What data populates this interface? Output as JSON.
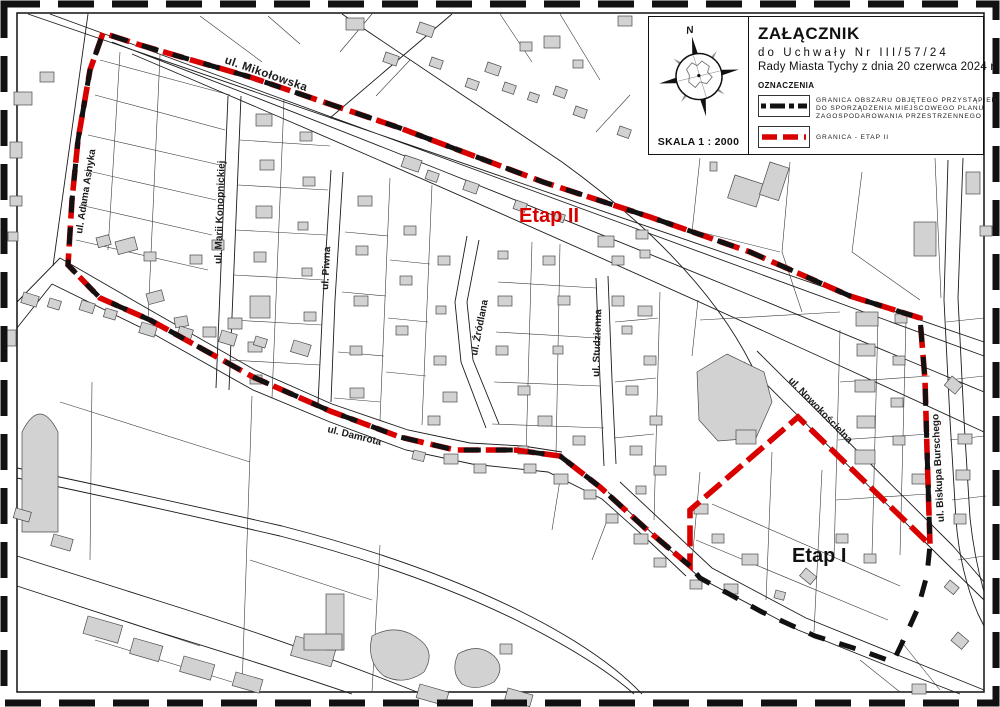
{
  "title_block": {
    "title": "ZAŁĄCZNIK",
    "subtitle1": "do Uchwały Nr III/57/24",
    "subtitle2": "Rady Miasta Tychy z dnia 20 czerwca 2024 r.",
    "legend_heading": "OZNACZENIA",
    "legend": [
      {
        "symbol": "black-dashed-line",
        "lines": [
          "GRANICA OBSZARU OBJĘTEGO PRZYSTĄPIENIEM",
          "DO SPORZĄDZENIA MIEJSCOWEGO PLANU",
          "ZAGOSPODAROWANIA PRZESTRZENNEGO"
        ]
      },
      {
        "symbol": "red-dashed-line",
        "label": "GRANICA - ETAP II"
      }
    ],
    "scale_label": "SKALA 1 : 2000",
    "compass_label": "N"
  },
  "map": {
    "streets": [
      "ul. Mikołowska",
      "ul. Adama Asnyka",
      "ul. Marii Konopnickiej",
      "ul. Piwna",
      "ul. Źródlana",
      "ul. Studzienna",
      "ul. Damrota",
      "ul. Nowokościelna",
      "ul. Biskupa Burschego"
    ],
    "area_labels": [
      {
        "text": "Etap II",
        "color": "#d90000"
      },
      {
        "text": "Etap I",
        "color": "#111111"
      }
    ]
  },
  "colors": {
    "boundary_black": "#111111",
    "boundary_red": "#d90000",
    "building_fill": "#d2d2d2",
    "line_color": "#1c1c1c"
  }
}
